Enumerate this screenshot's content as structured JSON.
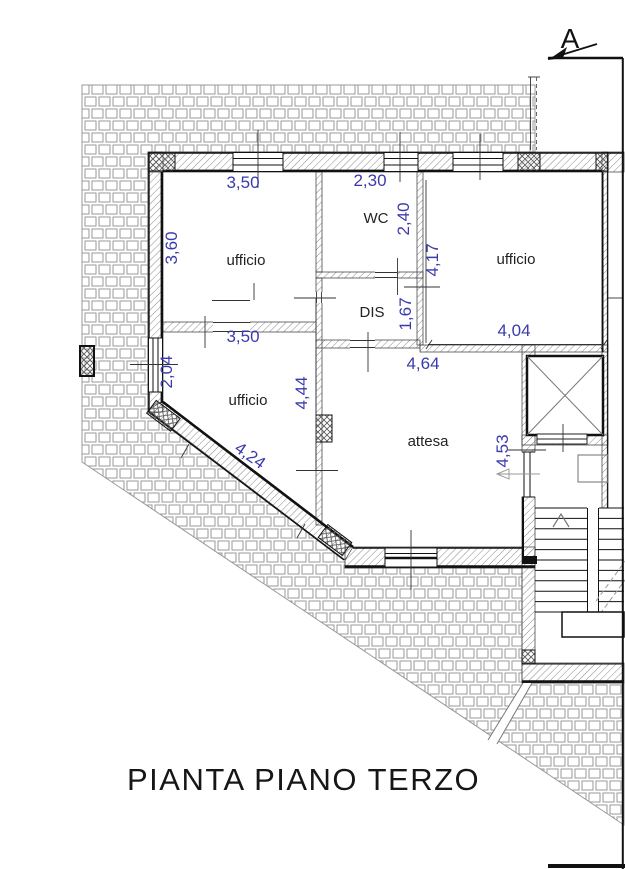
{
  "sheet": {
    "title": "PIANTA PIANO TERZO",
    "section_marker": "A"
  },
  "rooms": {
    "office_top_left": "ufficio",
    "wc": "WC",
    "office_top_right": "ufficio",
    "disimpegno": "DIS",
    "office_bottom_left": "ufficio",
    "waiting_room": "attesa"
  },
  "dimensions": {
    "office_top_left_width": "3,50",
    "office_top_left_depth": "3,60",
    "wc_width": "2,30",
    "wc_depth": "2,40",
    "office_top_right_depth": "4,17",
    "office_top_right_width": "4,04",
    "disimpegno_depth": "1,67",
    "office_bottom_left_width": "3,50",
    "office_bottom_left_side": "2,04",
    "office_bottom_left_depth": "4,44",
    "office_bottom_left_diagonal": "4,24",
    "waiting_room_width": "4,64",
    "waiting_room_depth": "4,53"
  },
  "colors": {
    "dimension_text": "#3a3aad",
    "label_text": "#222222",
    "line": "#111111"
  }
}
